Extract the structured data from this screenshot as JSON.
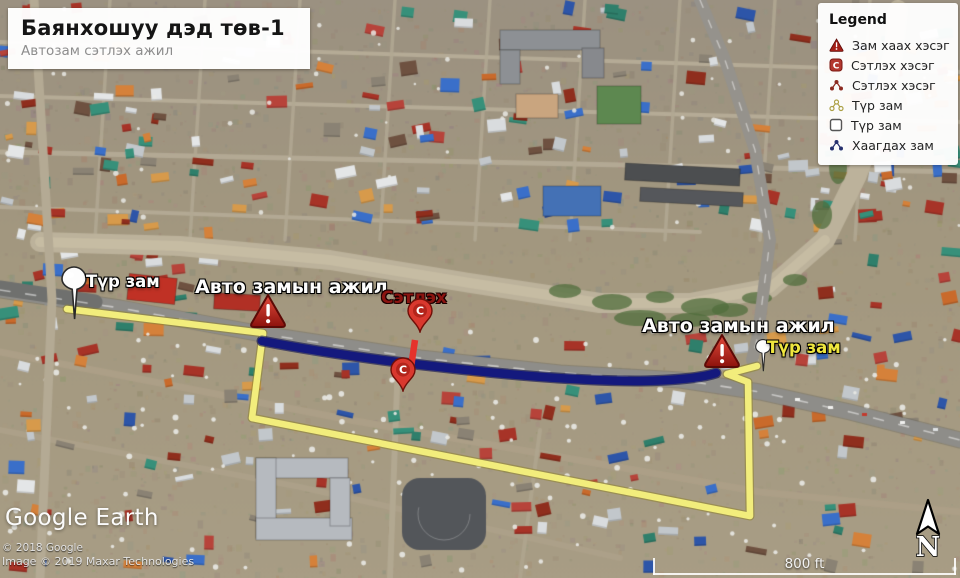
{
  "title_panel": {
    "title": "Баянхошуу дэд төв-1",
    "subtitle": "Автозам сэтлэх ажил"
  },
  "legend": {
    "title": "Legend",
    "items": [
      {
        "icon": "road-close-warning-icon",
        "label": "Зам хаах хэсэг"
      },
      {
        "icon": "cut-section-badge-icon",
        "label": "Сэтлэх хэсэг"
      },
      {
        "icon": "cut-section-path-icon",
        "label": "Сэтлэх хэсэг"
      },
      {
        "icon": "temp-road-path-icon",
        "label": "Түр зам"
      },
      {
        "icon": "temp-road-polygon-icon",
        "label": "Түр зам"
      },
      {
        "icon": "closed-road-path-icon",
        "label": "Хаагдах зам"
      }
    ]
  },
  "map_labels": {
    "temp_road_left": "Түр зам",
    "roadwork_left": "Авто замын ажил",
    "cut_point": "Сэтлэх",
    "roadwork_right": "Авто замын ажил",
    "temp_road_right": "Түр зам"
  },
  "markers": {
    "cut_pin_letter": "C"
  },
  "scale_bar": {
    "label": "800 ft"
  },
  "north_indicator": {
    "label": "N"
  },
  "watermark": {
    "logo": "Google Earth",
    "copyright_line1": "© 2018 Google",
    "copyright_line2": "Image © 2019 Maxar Technologies"
  },
  "colors": {
    "temporary_road": "#f2ed7c",
    "temporary_road_casing": "#8f842e",
    "closed_road": "#14197d",
    "closed_road_casing": "#0a0d4e",
    "cut_section": "#e5322b",
    "warning_red": "#b5241c",
    "pin_red": "#d9382e",
    "label_yellow": "#efe63e",
    "label_dark_red": "#8b1410"
  }
}
